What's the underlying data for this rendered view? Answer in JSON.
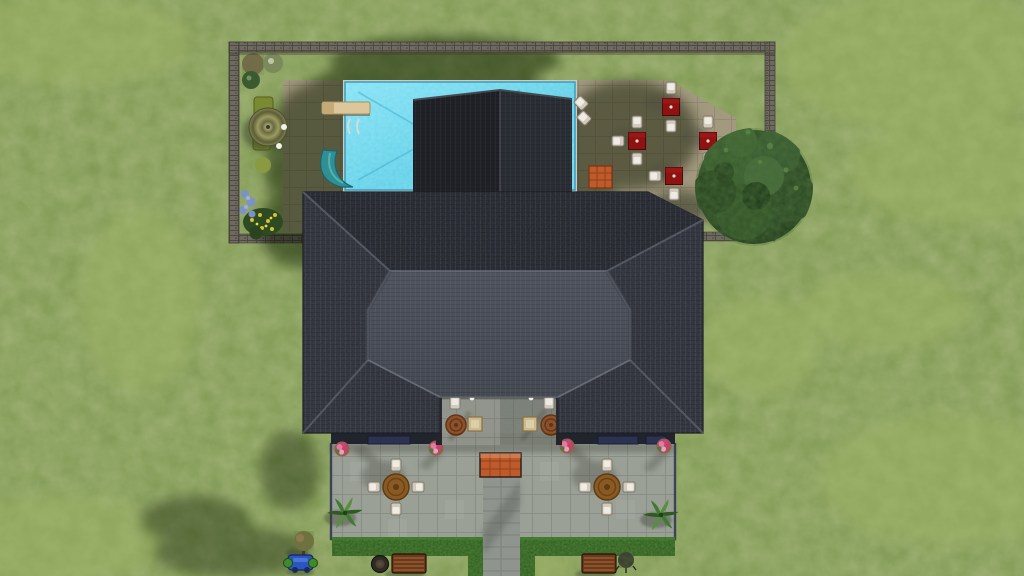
{
  "meta": {
    "app": "life-simulation-game",
    "view": "top-down aerial lot view",
    "scene": "suburban house lot with walled pool yard, outdoor dining area, inner courtyard and south terrace",
    "hud_visible": false,
    "text_on_screen": "none"
  },
  "palette": {
    "grass": "#7d9750",
    "grass_light": "#9db265",
    "grass_shadow": "#43532e",
    "deck_tan": "#a2997f",
    "patio_gray": "#9aa096",
    "walkway_gray": "#8f948e",
    "pool_water": "#6fd8ee",
    "pool_line": "#3d9cbc",
    "roof_dark": "#2c2f36",
    "roof_dark_north": "#24262d",
    "roof_inner": "#4a4e57",
    "roof_edge_line": "#666b75",
    "wing_left_face": "#1f2126",
    "wing_right_face": "#2a2d33",
    "wall_stone": "#6e6961",
    "hedge_green": "#2c581e",
    "table_red": "#8e1212",
    "round_table_brown": "#8a5a22",
    "chair_beige": "#d2cbbd",
    "steps_orange": "#bf5b2a",
    "awning_navy": "#2b3350",
    "pot_pink": "#c96f92",
    "tree_green": "#35562b",
    "bench_brown": "#6b3a1e",
    "toy_blue": "#2b56c0",
    "umbrella_olive": "#8a8a52",
    "slide_teal": "#2f8f93",
    "barrel_rust": "#8a4a20"
  },
  "titles": {
    "scene": "Top-down view of house lot",
    "lawn": "Lawn",
    "garden_wall": "Stone garden wall",
    "deck": "Pool deck paving",
    "pool": "Swimming pool",
    "diving_board": "Diving board",
    "pool_ladder": "Pool ladder",
    "pool_slide": "Pool slide",
    "umbrella": "Patio umbrella",
    "lounge": "Lounge chair",
    "shrubs": "Garden shrubs",
    "flower_bed": "Flower bed",
    "dining_area": "Outdoor dining area",
    "dining_table": "Red dining table",
    "dining_chair": "Dining chair",
    "orange_mat": "Terracotta step mat",
    "tree": "Large tree",
    "roof_main": "Main hip roof",
    "roof_inner": "Lower front roof",
    "roof_wing": "Rear wing roof",
    "courtyard": "Inner courtyard",
    "barrel_table": "Barrel table",
    "patio": "South terrace",
    "round_table": "Round patio table",
    "patio_chair": "Patio chair",
    "flower_pot": "Pink flower pot",
    "palm": "Palm plant",
    "hedge": "Hedge row",
    "walkway": "Front walkway",
    "steps": "Orange steps",
    "awning": "Navy window awning",
    "bench": "Garden bench",
    "fire_pit": "Fire pit",
    "toy": "Blue toy",
    "sapling": "Young sapling",
    "shadow": "Cast shadow"
  },
  "counts": {
    "red_dining_tables": 4,
    "dining_chairs": 11,
    "round_patio_tables": 2,
    "patio_chairs": 8,
    "barrel_tables": 2,
    "pink_flower_pots": 4,
    "palm_plants": 2,
    "benches": 2,
    "trees_large": 1,
    "pools": 1
  },
  "objects": [
    {
      "name": "walled-yard",
      "label": "Walled backyard",
      "approx": "x232-775 y42-243"
    },
    {
      "name": "pool",
      "label": "Swimming pool",
      "approx": "x345-575 y82-190"
    },
    {
      "name": "dining-area",
      "label": "Dining patio with 4 red tables",
      "approx": "x575-736 y80-230"
    },
    {
      "name": "tree",
      "label": "Large round tree",
      "approx": "center 754,187"
    },
    {
      "name": "house-roof",
      "label": "Charcoal hip roof",
      "approx": "x303-703 y192-433"
    },
    {
      "name": "courtyard",
      "label": "Courtyard gap in roof",
      "approx": "x440-558 y397-445"
    },
    {
      "name": "terrace",
      "label": "South terrace",
      "approx": "x331-675 y443-539"
    },
    {
      "name": "walkway",
      "label": "Walkway to street",
      "approx": "x483-520 y475-576"
    }
  ]
}
